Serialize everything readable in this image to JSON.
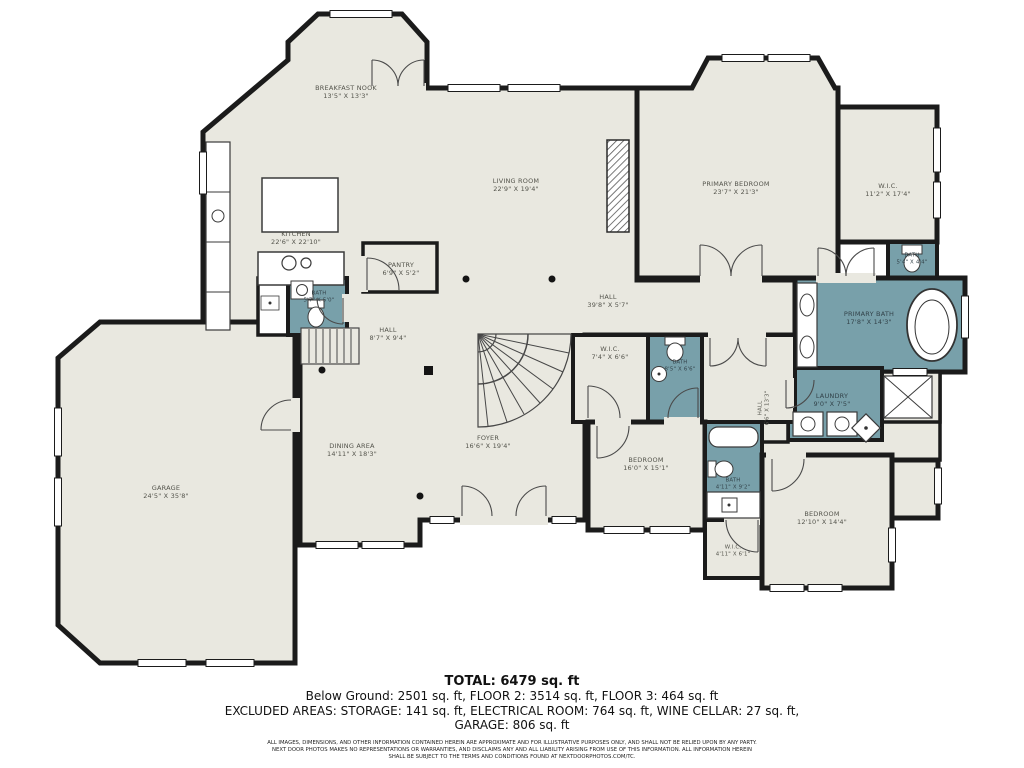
{
  "plan": {
    "colors": {
      "floor": "#e9e8e0",
      "wet_room": "#78a0aa",
      "wall": "#1b1b1b"
    },
    "rooms": {
      "breakfast_nook": {
        "name": "BREAKFAST NOOK",
        "dims": "13'5\" X 13'3\""
      },
      "kitchen": {
        "name": "KITCHEN",
        "dims": "22'6\" X 22'10\""
      },
      "living_room": {
        "name": "LIVING ROOM",
        "dims": "22'9\" X 19'4\""
      },
      "primary_bedroom": {
        "name": "PRIMARY BEDROOM",
        "dims": "23'7\" X 21'3\""
      },
      "primary_wic": {
        "name": "W.I.C.",
        "dims": "11'2\" X 17'4\""
      },
      "bath_top_right": {
        "name": "BATH",
        "dims": "5'4\" X 4'4\""
      },
      "primary_bath": {
        "name": "PRIMARY BATH",
        "dims": "17'8\" X 14'3\""
      },
      "pantry": {
        "name": "PANTRY",
        "dims": "6'9\" X 5'2\""
      },
      "bath_kitchen": {
        "name": "BATH",
        "dims": "5'7\" X 5'0\""
      },
      "hall_stairs": {
        "name": "HALL",
        "dims": "8'7\" X 9'4\""
      },
      "hall_long": {
        "name": "HALL",
        "dims": "39'8\" X 5'7\""
      },
      "wic_middle": {
        "name": "W.I.C.",
        "dims": "7'4\" X 6'6\""
      },
      "bath_middle": {
        "name": "BATH",
        "dims": "8'5\" X 6'6\""
      },
      "hall_vertical": {
        "name": "HALL",
        "dims": "6'6\" X 13'3\""
      },
      "laundry": {
        "name": "LAUNDRY",
        "dims": "9'0\" X 7'5\""
      },
      "garage": {
        "name": "GARAGE",
        "dims": "24'5\" X 35'8\""
      },
      "dining_area": {
        "name": "DINING AREA",
        "dims": "14'11\" X 18'3\""
      },
      "foyer": {
        "name": "FOYER",
        "dims": "16'6\" X 19'4\""
      },
      "bedroom_middle": {
        "name": "BEDROOM",
        "dims": "16'0\" X 15'1\""
      },
      "bath_bottom": {
        "name": "BATH",
        "dims": "4'11\" X 9'2\""
      },
      "wic_bottom": {
        "name": "W.I.C.",
        "dims": "4'11\" X 6'1\""
      },
      "bedroom_right": {
        "name": "BEDROOM",
        "dims": "12'10\" X 14'4\""
      }
    }
  },
  "summary": {
    "total": "TOTAL: 6479 sq. ft",
    "line1": "Below Ground: 2501 sq. ft, FLOOR 2: 3514 sq. ft, FLOOR 3: 464 sq. ft",
    "line2": "EXCLUDED AREAS: STORAGE: 141 sq. ft, ELECTRICAL ROOM: 764 sq. ft, WINE CELLAR: 27 sq. ft,",
    "line3": "GARAGE: 806 sq. ft"
  },
  "disclaimer": {
    "line1": "ALL IMAGES, DIMENSIONS, AND OTHER INFORMATION CONTAINED HEREIN ARE APPROXIMATE AND FOR ILLUSTRATIVE PURPOSES ONLY, AND SHALL NOT BE RELIED UPON BY ANY PARTY.",
    "line2": "NEXT DOOR PHOTOS MAKES NO REPRESENTATIONS OR WARRANTIES, AND DISCLAIMS ANY AND ALL LIABILITY ARISING FROM USE OF THIS INFORMATION. ALL INFORMATION HEREIN",
    "line3": "SHALL BE SUBJECT TO THE TERMS AND CONDITIONS FOUND AT NEXTDOORPHOTOS.COM/TC."
  }
}
